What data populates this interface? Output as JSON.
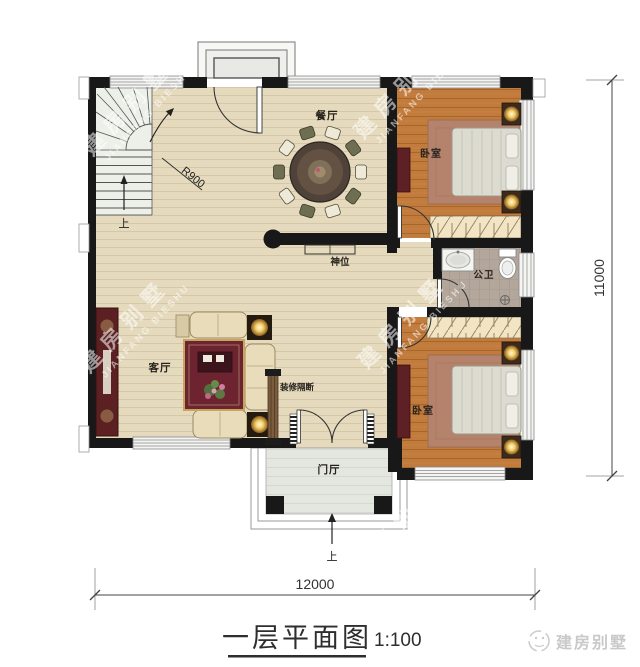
{
  "title": {
    "text": "一层平面图",
    "scale": "1:100"
  },
  "logo": {
    "text": "建房别墅"
  },
  "watermark": {
    "cn": "建房别墅",
    "en": "JIANFANG BIESHU"
  },
  "dimensions": {
    "bottom": "12000",
    "right": "11000"
  },
  "rooms": {
    "dining": "餐厅",
    "living": "客厅",
    "bedroom1": "卧室",
    "bedroom2": "卧室",
    "bathroom": "公卫",
    "entry": "门厅",
    "shrine": "神位",
    "partition": "装修隔断"
  },
  "stairs": {
    "up": "上",
    "radius": "R900"
  },
  "entry_steps": {
    "up": "上"
  },
  "colors": {
    "wall": "#181818",
    "floor_main": "#e5dabd",
    "floor_bedroom": "#c17b3c",
    "floor_bath": "#b3a69b",
    "rug_red": "#6e2430"
  }
}
